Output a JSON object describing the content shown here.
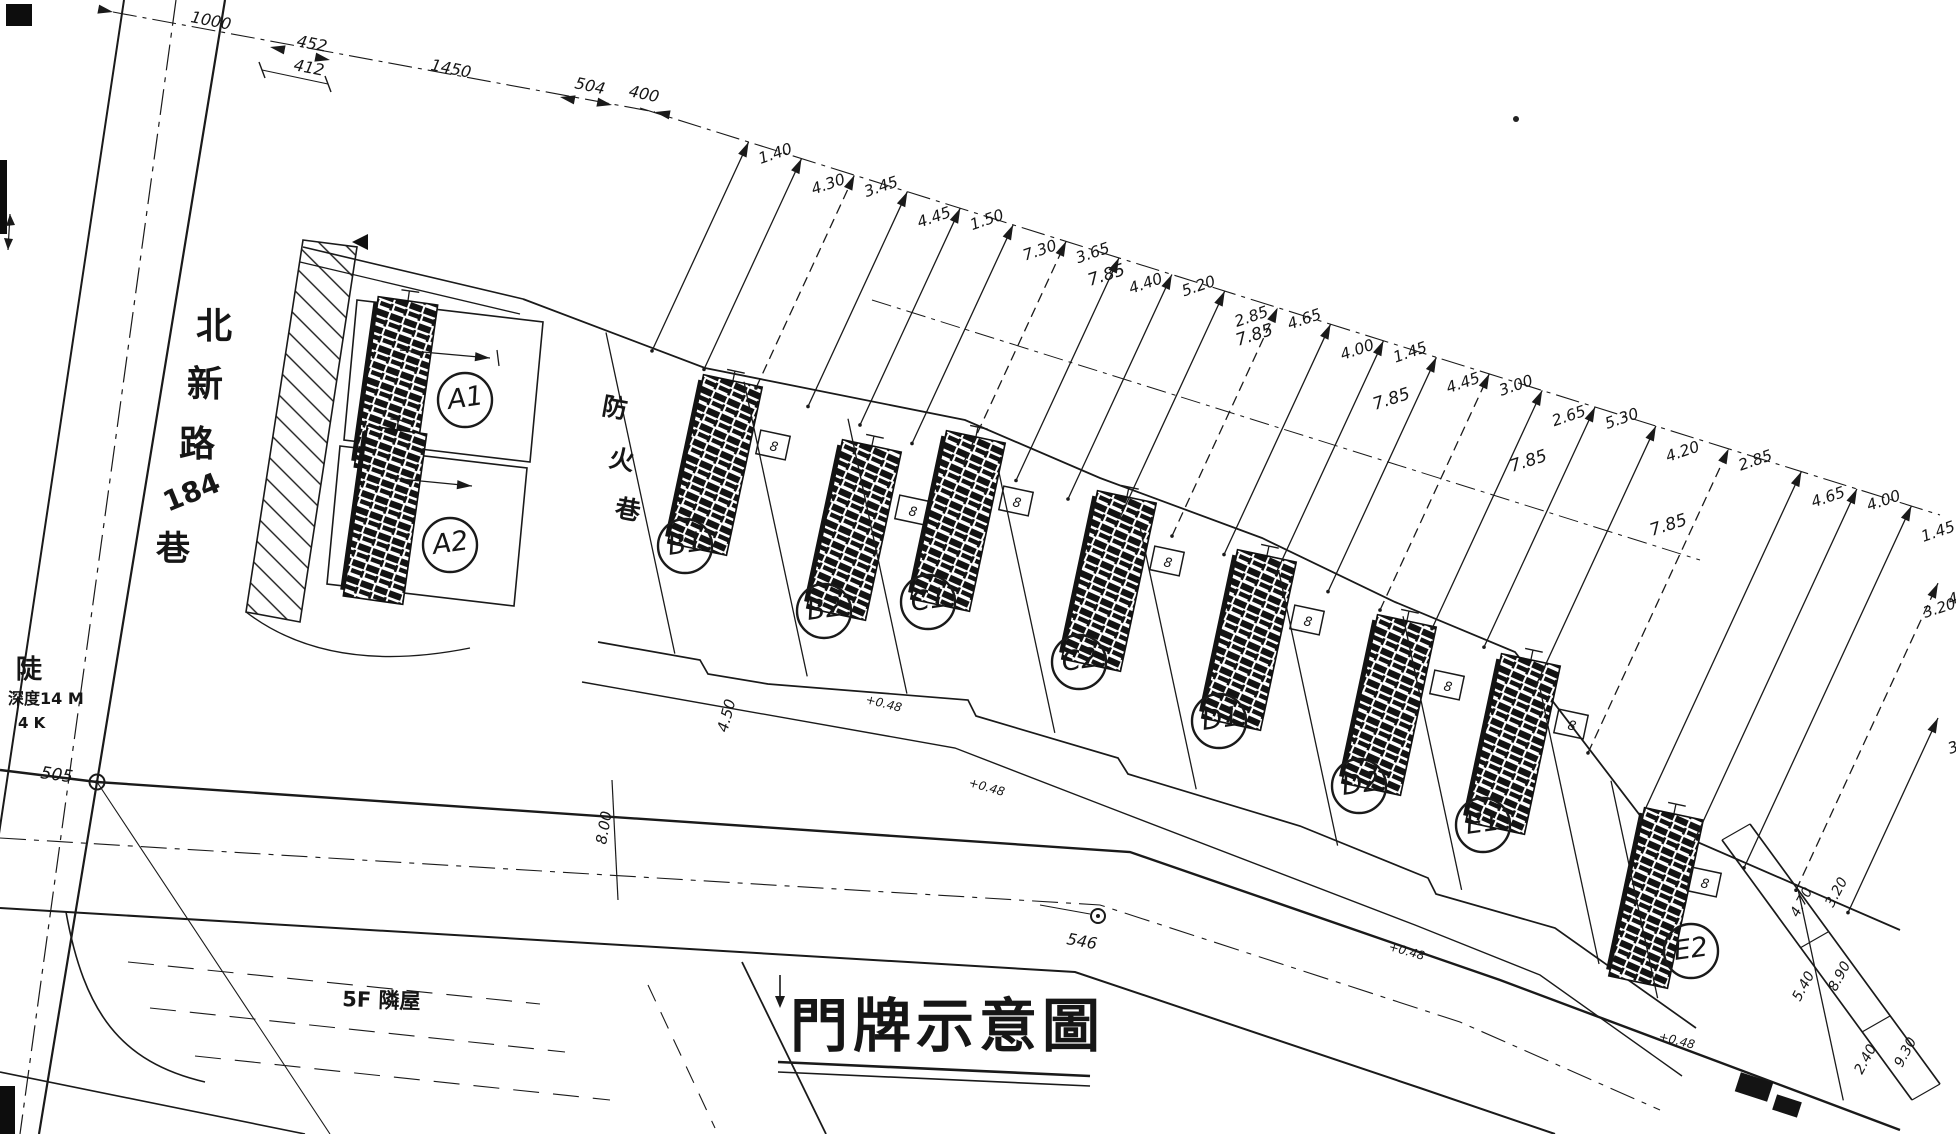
{
  "title": {
    "text": "門牌示意圖"
  },
  "street": {
    "chars": [
      "北",
      "新",
      "路",
      "184",
      "巷"
    ]
  },
  "fire_lane": {
    "chars": [
      "防",
      "火",
      "巷"
    ]
  },
  "notes": {
    "neighbor": "5F 隣屋",
    "slope1": "陡",
    "slope2": "深度14 M",
    "slope3": "4 K",
    "p505": "505",
    "p546": "546"
  },
  "buildings": [
    {
      "id": "A1",
      "cx": 465,
      "cy": 400,
      "sx": 396,
      "sy": 386,
      "rot": 8,
      "box": [
        0,
        0
      ],
      "hasBox": false
    },
    {
      "id": "A2",
      "cx": 450,
      "cy": 545,
      "sx": 385,
      "sy": 515,
      "rot": 8,
      "box": [
        0,
        0
      ],
      "hasBox": false
    },
    {
      "id": "B1",
      "cx": 685,
      "cy": 546,
      "sx": 715,
      "sy": 465,
      "rot": 12,
      "box": [
        773,
        445
      ],
      "hasBox": true
    },
    {
      "id": "B2",
      "cx": 824,
      "cy": 611,
      "sx": 854,
      "sy": 530,
      "rot": 12,
      "box": [
        912,
        510
      ],
      "hasBox": true
    },
    {
      "id": "C1",
      "cx": 928,
      "cy": 602,
      "sx": 958,
      "sy": 521,
      "rot": 12,
      "box": [
        1016,
        501
      ],
      "hasBox": true
    },
    {
      "id": "C2",
      "cx": 1079,
      "cy": 662,
      "sx": 1109,
      "sy": 581,
      "rot": 12,
      "box": [
        1167,
        561
      ],
      "hasBox": true
    },
    {
      "id": "D1",
      "cx": 1219,
      "cy": 721,
      "sx": 1249,
      "sy": 640,
      "rot": 12,
      "box": [
        1307,
        620
      ],
      "hasBox": true
    },
    {
      "id": "D2",
      "cx": 1359,
      "cy": 786,
      "sx": 1389,
      "sy": 705,
      "rot": 12,
      "box": [
        1447,
        685
      ],
      "hasBox": true
    },
    {
      "id": "E1",
      "cx": 1483,
      "cy": 825,
      "sx": 1513,
      "sy": 744,
      "rot": 12,
      "box": [
        1571,
        724
      ],
      "hasBox": true
    },
    {
      "id": "E2",
      "cx": 1691,
      "cy": 951,
      "sx": 1656,
      "sy": 898,
      "rot": 12,
      "box": [
        1704,
        882
      ],
      "hasBox": true
    }
  ],
  "dims": {
    "entry_mark": "8",
    "top_chain": [
      {
        "t": "1000",
        "x": 190,
        "y": 22,
        "r": 11
      },
      {
        "t": "452",
        "x": 296,
        "y": 46,
        "r": 11
      },
      {
        "t": "412",
        "x": 293,
        "y": 70,
        "r": 11
      },
      {
        "t": "1450",
        "x": 430,
        "y": 70,
        "r": 11
      },
      {
        "t": "504",
        "x": 574,
        "y": 88,
        "r": 12
      },
      {
        "t": "400",
        "x": 628,
        "y": 96,
        "r": 12
      }
    ],
    "fan_values": [
      "1.40",
      "4.30",
      "3.45",
      "4.45",
      "1.50",
      "7.30",
      "3.65",
      "4.40",
      "5.20",
      "2.85",
      "4.65",
      "4.00",
      "1.45",
      "4.45",
      "3.00",
      "2.65",
      "5.30",
      "4.20",
      "2.85",
      "4.65",
      "4.00",
      "1.45",
      "4.45",
      "3.20"
    ],
    "mid": [
      {
        "t": "7.85",
        "x": 1090,
        "y": 286
      },
      {
        "t": "7.85",
        "x": 1238,
        "y": 346
      },
      {
        "t": "7.85",
        "x": 1375,
        "y": 410
      },
      {
        "t": "7.85",
        "x": 1512,
        "y": 472
      },
      {
        "t": "7.85",
        "x": 1652,
        "y": 536
      }
    ],
    "right": [
      {
        "t": "4.70",
        "x": 1798,
        "y": 918,
        "r": -62
      },
      {
        "t": "3.20",
        "x": 1833,
        "y": 908,
        "r": -62
      },
      {
        "t": "5.40",
        "x": 1800,
        "y": 1002,
        "r": -62
      },
      {
        "t": "8.90",
        "x": 1836,
        "y": 992,
        "r": -62
      },
      {
        "t": "2.40",
        "x": 1862,
        "y": 1075,
        "r": -62
      },
      {
        "t": "9.30",
        "x": 1902,
        "y": 1068,
        "r": -62
      }
    ],
    "misc": [
      {
        "t": "4.50",
        "x": 727,
        "y": 733,
        "r": -75
      },
      {
        "t": "8.00",
        "x": 606,
        "y": 845,
        "r": -80
      },
      {
        "t": "3.20",
        "x": 1925,
        "y": 618,
        "r": -18
      }
    ],
    "annotations": [
      {
        "t": "+0.48",
        "x": 865,
        "y": 703,
        "r": 14
      },
      {
        "t": "+0.48",
        "x": 968,
        "y": 786,
        "r": 16
      },
      {
        "t": "+0.48",
        "x": 1388,
        "y": 950,
        "r": 16
      },
      {
        "t": "+0.48",
        "x": 1658,
        "y": 1040,
        "r": 14
      }
    ]
  }
}
